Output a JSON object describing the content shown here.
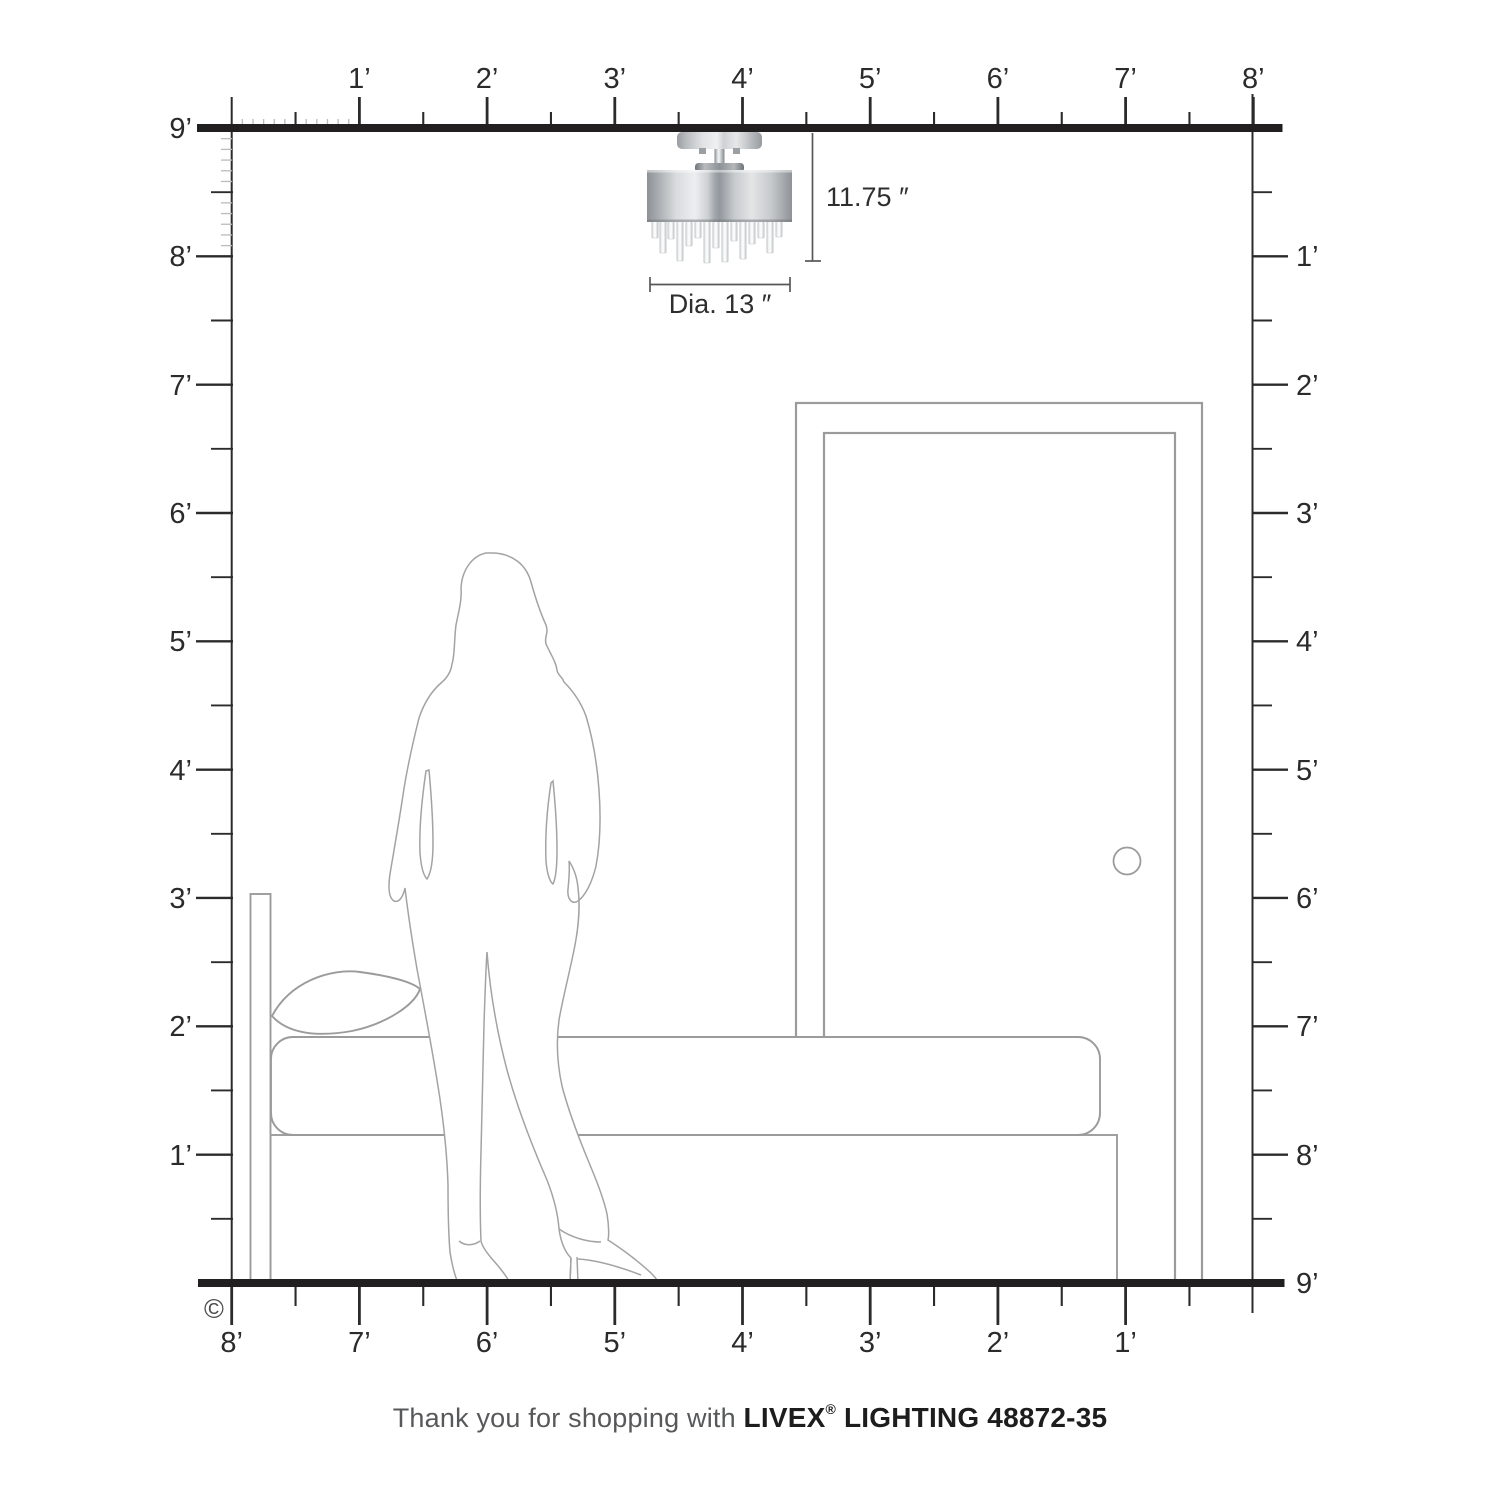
{
  "page": {
    "copyright": "©"
  },
  "colors": {
    "ink": "#2b2b2b",
    "outline": "#9d9d9d",
    "wall_band": "#221f20"
  },
  "rulers": {
    "top": {
      "labels": [
        "1’",
        "2’",
        "3’",
        "4’",
        "5’",
        "6’",
        "7’",
        "8’"
      ]
    },
    "left": {
      "labels": [
        "9’",
        "8’",
        "7’",
        "6’",
        "5’",
        "4’",
        "3’",
        "2’",
        "1’"
      ]
    },
    "right": {
      "labels": [
        "1’",
        "2’",
        "3’",
        "4’",
        "5’",
        "6’",
        "7’",
        "8’",
        "9’"
      ]
    },
    "bottom": {
      "labels": [
        "8’",
        "7’",
        "6’",
        "5’",
        "4’",
        "3’",
        "2’",
        "1’"
      ]
    }
  },
  "fixture": {
    "height_label": "11.75 ″",
    "diameter_label": "Dia. 13 ″"
  },
  "footer": {
    "prefix": "Thank you for shopping with ",
    "brand": "LIVEX",
    "registered": "®",
    "suffix": " LIGHTING 48872-35"
  }
}
